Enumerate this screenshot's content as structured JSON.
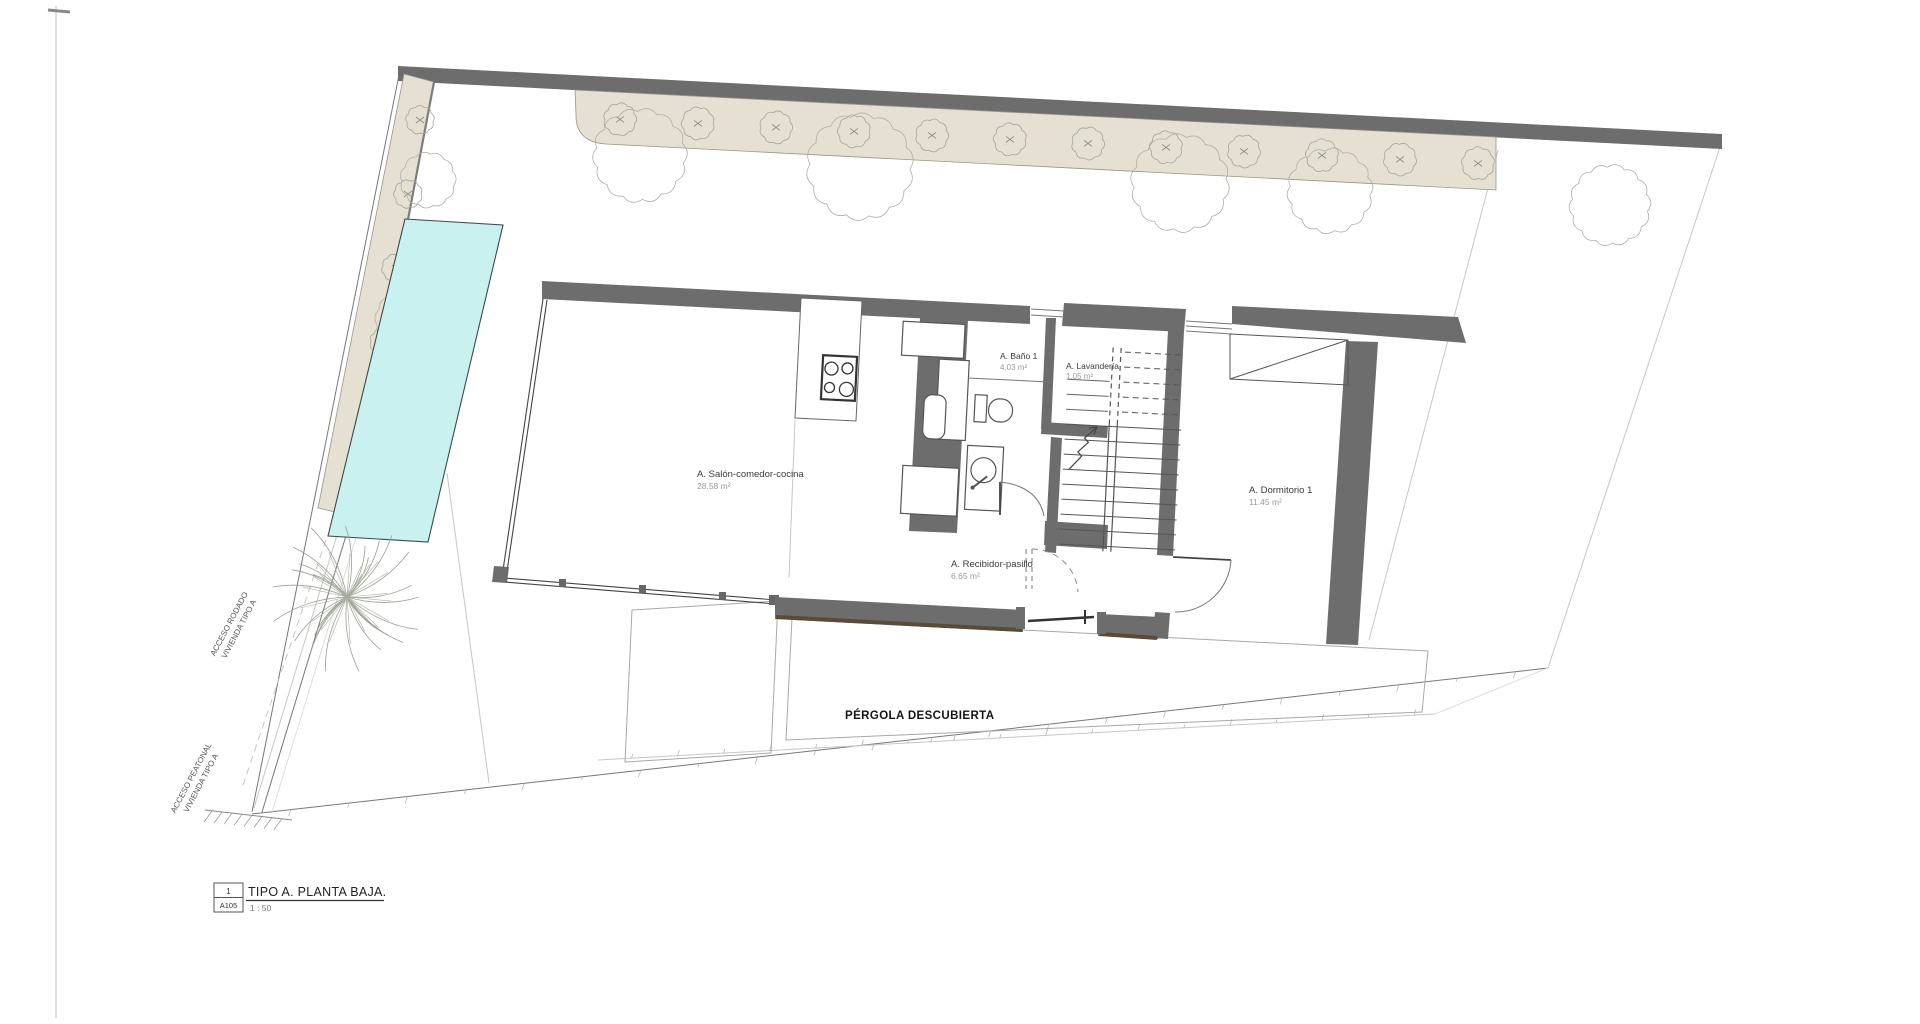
{
  "drawing": {
    "type": "architectural-floor-plan",
    "rooms": [
      {
        "id": "salon",
        "name": "A. Salón-comedor-cocina",
        "area": "28.58 m²"
      },
      {
        "id": "bano",
        "name": "A. Baño 1",
        "area": "4.03 m²"
      },
      {
        "id": "lavanderia",
        "name": "A. Lavandería",
        "area": "1.05 m²"
      },
      {
        "id": "recibidor",
        "name": "A. Recibidor-pasillo",
        "area": "6.65 m²"
      },
      {
        "id": "dormitorio",
        "name": "A. Dormitorio 1",
        "area": "11.45 m²"
      }
    ],
    "outdoor": {
      "pergola_label": "PÉRGOLA DESCUBIERTA"
    },
    "site_labels": {
      "acceso_rodado": {
        "line1": "ACCESO RODADO",
        "line2": "VIVIENDA TIPO A"
      },
      "acceso_peatonal": {
        "line1": "ACCESO PEATONAL",
        "line2": "VIVIENDA TIPO A"
      }
    },
    "title_block": {
      "detail_number": "1",
      "sheet": "A105",
      "title": "TIPO A. PLANTA BAJA.",
      "scale": "1 : 50"
    }
  },
  "colors": {
    "wall_dark": "#6d6d6d",
    "wall_shadow": "#5a4a3a",
    "planting_fill": "#e6e0d2",
    "planting_stroke": "#9b9588",
    "pool_fill": "#c8f1ef",
    "pool_stroke": "#3c4a4a",
    "vegetation": "#a3a79a",
    "text_dark": "#3a3a3a",
    "text_area": "#9b9b9b",
    "text_black": "#141414"
  }
}
